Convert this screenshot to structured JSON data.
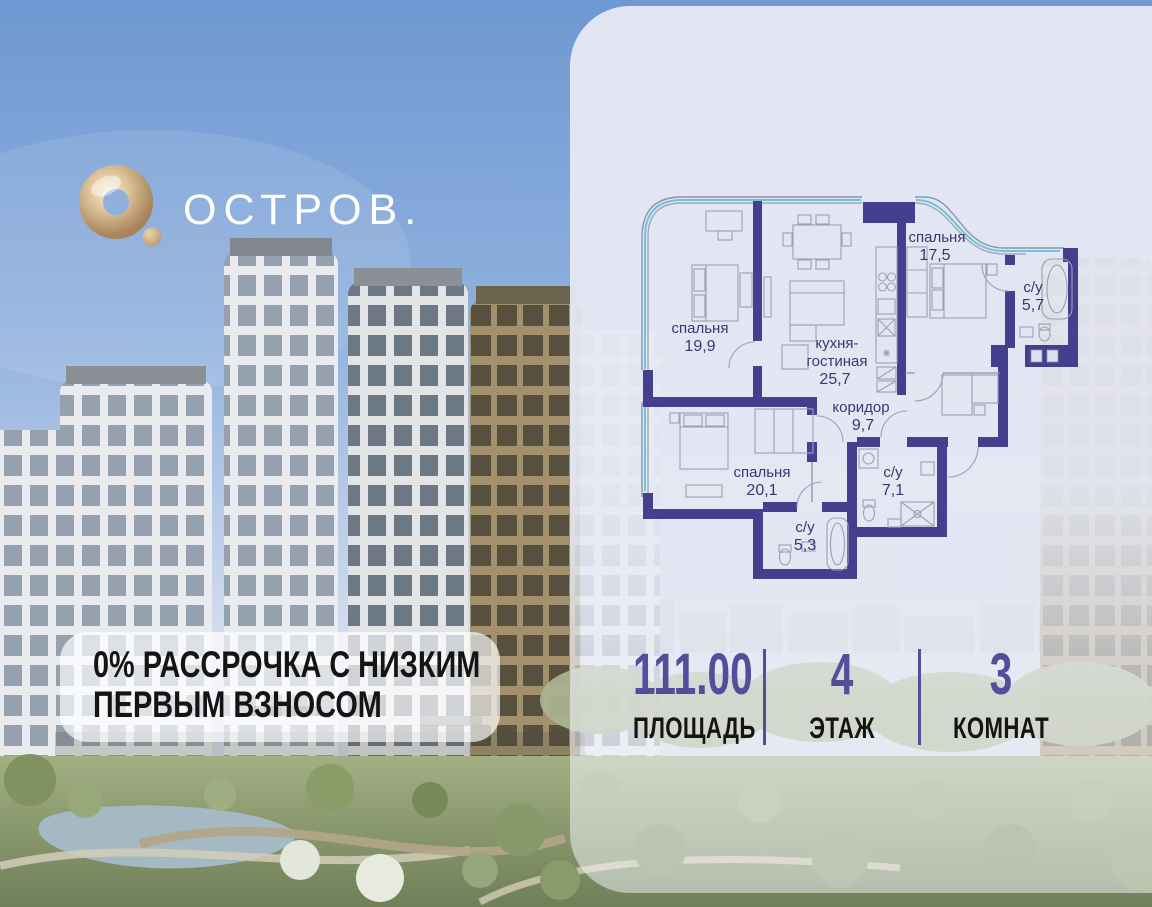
{
  "brand": {
    "name": "ОСТРОВ."
  },
  "promo": {
    "line1": "0% РАССРОЧКА С НИЗКИМ",
    "line2": "ПЕРВЫМ ВЗНОСОМ"
  },
  "floorplan": {
    "rooms": [
      {
        "name": "спальня",
        "area": "19,9"
      },
      {
        "name_line1": "кухня-",
        "name_line2": "гостиная",
        "area": "25,7"
      },
      {
        "name": "спальня",
        "area": "17,5"
      },
      {
        "name": "с/у",
        "area": "5,7"
      },
      {
        "name": "коридор",
        "area": "9,7"
      },
      {
        "name": "спальня",
        "area": "20,1"
      },
      {
        "name": "с/у",
        "area": "7,1"
      },
      {
        "name": "с/у",
        "area": "5,3"
      }
    ]
  },
  "stats": [
    {
      "value": "111.00",
      "label": "ПЛОЩАДЬ"
    },
    {
      "value": "4",
      "label": "ЭТАЖ"
    },
    {
      "value": "3",
      "label": "КОМНАТ"
    }
  ],
  "colors": {
    "accent_purple": "#544d9b",
    "wall_purple": "#453f8f",
    "window_cyan": "#6cc5dc",
    "logo_gold": "#c9a97c",
    "plan_label": "#3b3672"
  }
}
